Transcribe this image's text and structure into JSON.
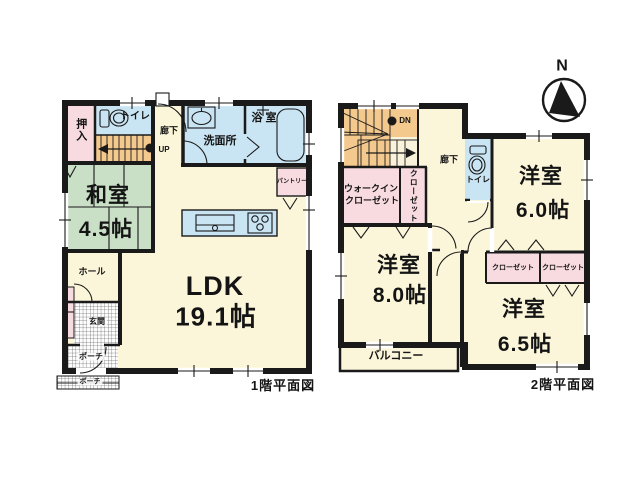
{
  "palette": {
    "wall": "#1a1a1a",
    "floor": "#FBF6DA",
    "tatami": "#C9DFC6",
    "wet": "#C9E4F3",
    "closet": "#F8DBE1",
    "stairs": "#F4C98E",
    "landing": "#FAF3DC"
  },
  "compass": {
    "label": "N"
  },
  "floor1": {
    "caption": "1階平面図",
    "washitsu_name": "和室",
    "washitsu_size": "4.5帖",
    "ldk_name": "LDK",
    "ldk_size": "19.1帖",
    "oshiire": "押入",
    "toilet": "トイレ",
    "corridor": "廊下",
    "up": "UP",
    "washroom": "洗面所",
    "bath": "浴 室",
    "pantry": "パントリー",
    "hall": "ホール",
    "entrance": "玄関",
    "porch": "ポーチ",
    "approach": "ポーチ"
  },
  "floor2": {
    "caption": "2階平面図",
    "dn": "DN",
    "corridor": "廊下",
    "wic_line1": "ウォークイン",
    "wic_line2": "クローゼット",
    "closet_vertical": "クローゼット",
    "toilet": "トイレ",
    "room60_name": "洋室",
    "room60_size": "6.0帖",
    "room80_name": "洋室",
    "room80_size": "8.0帖",
    "room65_name": "洋室",
    "room65_size": "6.5帖",
    "closet_a": "クローゼット",
    "closet_b": "クローゼット",
    "balcony": "バルコニー"
  }
}
